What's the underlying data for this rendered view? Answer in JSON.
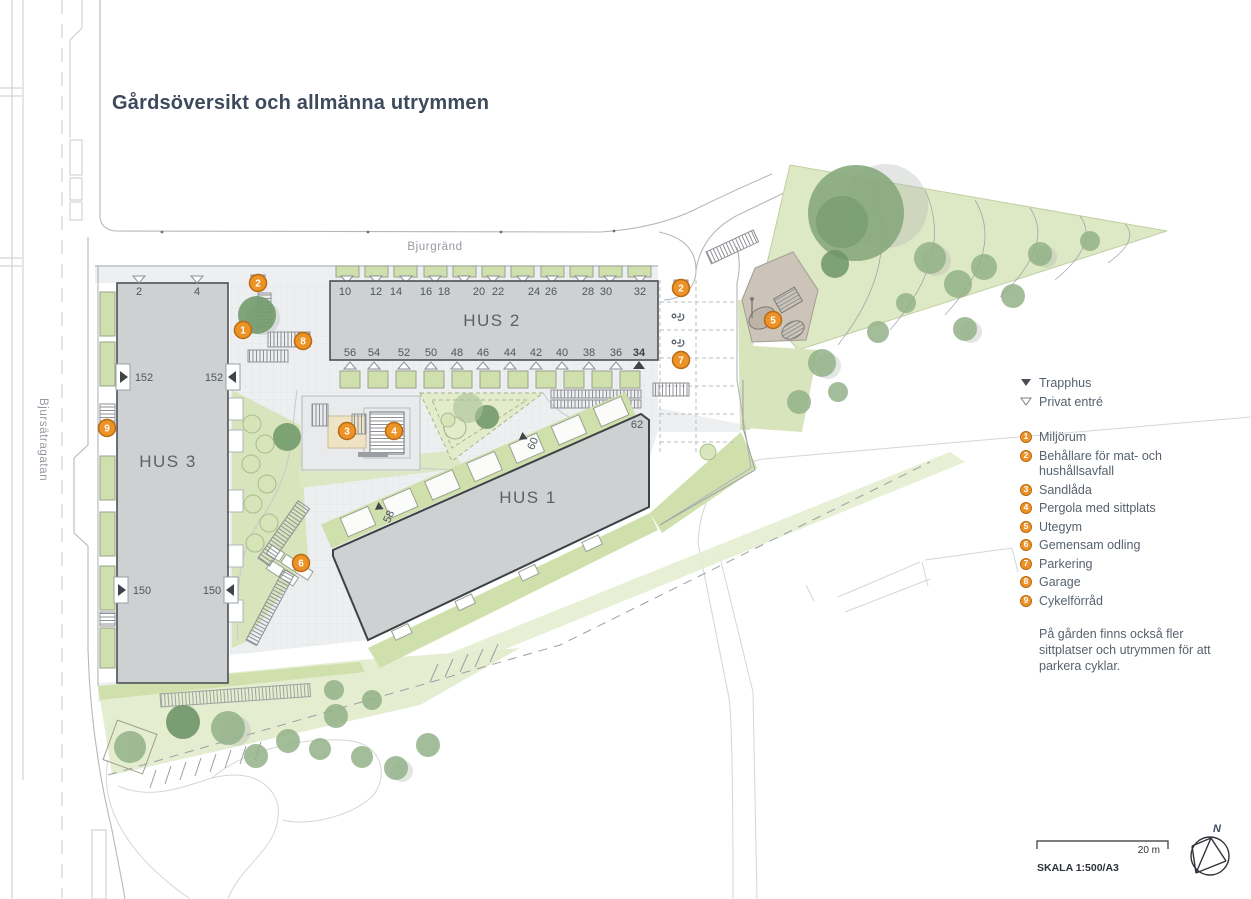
{
  "title": "Gårdsöversikt och allmänna utrymmen",
  "streets": {
    "top": "Bjurgränd",
    "left": "Bjursätragatan"
  },
  "buildings": {
    "hus1": {
      "label": "HUS 1",
      "entrance_numbers": [
        "58",
        "60",
        "62"
      ]
    },
    "hus2": {
      "label": "HUS 2",
      "numbers_top": [
        "10",
        "12",
        "14",
        "16",
        "18",
        "20",
        "22",
        "24",
        "26",
        "28",
        "30",
        "32"
      ],
      "numbers_bottom": [
        "56",
        "54",
        "52",
        "50",
        "48",
        "46",
        "44",
        "42",
        "40",
        "38",
        "36",
        "34"
      ]
    },
    "hus3": {
      "label": "HUS 3",
      "numbers_top": [
        "2",
        "4"
      ],
      "stairwell_numbers": [
        "152",
        "150"
      ]
    }
  },
  "map_markers": [
    "1",
    "2",
    "2",
    "3",
    "4",
    "5",
    "6",
    "7",
    "8",
    "9"
  ],
  "legend": {
    "trapphus_label": "Trapphus",
    "privat_entre_label": "Privat entré",
    "items": [
      {
        "num": "1",
        "label": "Miljörum"
      },
      {
        "num": "2",
        "label": "Behållare för mat- och hushållsavfall"
      },
      {
        "num": "3",
        "label": "Sandlåda"
      },
      {
        "num": "4",
        "label": "Pergola med sittplats"
      },
      {
        "num": "5",
        "label": "Utegym"
      },
      {
        "num": "6",
        "label": "Gemensam odling"
      },
      {
        "num": "7",
        "label": "Parkering"
      },
      {
        "num": "8",
        "label": "Garage"
      },
      {
        "num": "9",
        "label": "Cykelförråd"
      }
    ],
    "note": "På gården finns också fler sittplatser och utrymmen för att parkera cyklar."
  },
  "scale_bar": {
    "distance_label": "20 m",
    "scale_label": "SKALA 1:500/A3",
    "north_label": "N"
  },
  "colors": {
    "accent_orange": "#ed9227",
    "building_fill": "#ced1d2",
    "green_light": "#dce7c3",
    "title_color": "#3d4a5c"
  }
}
